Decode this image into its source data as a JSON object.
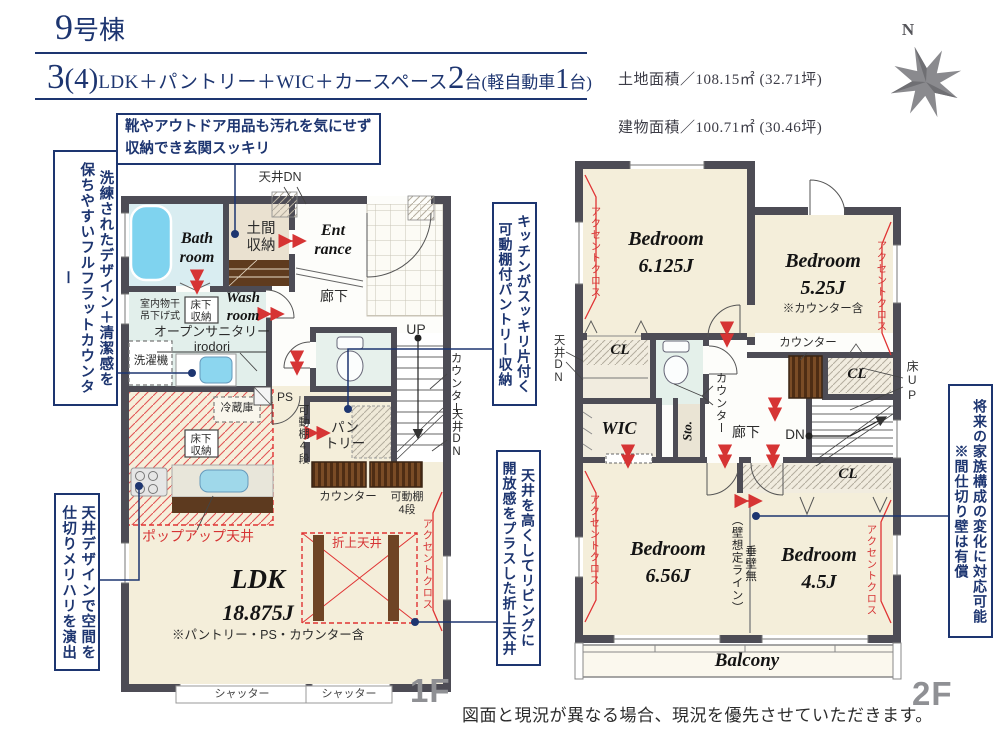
{
  "header": {
    "building_num": "9",
    "building_suffix": "号棟",
    "plan_num": "3",
    "plan_paren": "(4)",
    "plan_text": "LDK＋パントリー＋WIC＋カースペース",
    "plan_cars": "2",
    "plan_cars_unit": "台",
    "plan_kei_pre": "(軽自動車",
    "plan_kei_num": "1",
    "plan_kei_post": "台)",
    "land_area": "土地面積／108.15㎡ (32.71坪)",
    "building_area": "建物面積／100.71㎡ (30.46坪)",
    "compass_n": "N"
  },
  "callouts": {
    "genkan_l1": "靴やアウトドア用品も汚れを気にせず",
    "genkan_l2": "収納でき玄関スッキリ",
    "counter_l1": "洗練されたデザイン＋清潔感を",
    "counter_l2": "保ちやすいフルフラットカウンター",
    "pantry_l1": "キッチンがスッキリ片付く",
    "pantry_l2": "可動棚付パントリー収納",
    "ceiling_l1": "天井デザインで空間を",
    "ceiling_l2": "仕切りメリハリを演出",
    "oriage_l1": "天井を高くしてリビングに",
    "oriage_l2": "開放感をプラスした折上天井",
    "partition_l1": "将来の家族構成の変化に対応可能",
    "partition_l2": "※間仕切り壁は有償"
  },
  "floor1": {
    "floor_label": "1F",
    "tenjo_dn": "天井DN",
    "bath": "Bath\nroom",
    "doma": "土間\n収納",
    "entrance": "Ent\nrance",
    "hallway": "廊下",
    "wash": "Wash\nroom",
    "monohoshi": "室内物干\n吊下げ式",
    "yukashita": "床下\n収納",
    "sanitary": "オープンサニタリー\nirodori",
    "sentakuki": "洗濯機",
    "up": "UP",
    "ps": "PS",
    "kadodana_left": "可動棚4段",
    "pantry": "パン\nトリー",
    "reizoko": "冷蔵庫",
    "yukashita2": "床下\n収納",
    "counter": "カウンター",
    "kadodana_right": "可動棚\n4段",
    "counter_v": "カウンター",
    "tenjo_dn_v": "天井DN",
    "popup": "ポップアップ天井",
    "oriage": "折上天井",
    "accent": "アクセントクロス",
    "ldk": "LDK",
    "ldk_size": "18.875J",
    "ldk_note": "※パントリー・PS・カウンター含",
    "shutter1": "シャッター",
    "shutter2": "シャッター"
  },
  "floor2": {
    "floor_label": "2F",
    "bedroom1": "Bedroom\n6.125J",
    "bedroom2": "Bedroom\n5.25J",
    "bedroom2_note": "※カウンター含",
    "bedroom3": "Bedroom\n6.56J",
    "bedroom4": "Bedroom\n4.5J",
    "tenjo_dn": "天井DN",
    "cl1": "CL",
    "cl2": "CL",
    "cl3": "CL",
    "counter_top": "カウンター",
    "counter_v": "カウンター",
    "yuka_up": "床UP",
    "wic": "WIC",
    "sto": "Sto.",
    "hallway": "廊下",
    "dn": "DN",
    "tarekabe_l1": "垂壁無",
    "tarekabe_l2": "（壁想定ライン）",
    "accent1": "アクセントクロス",
    "accent2": "アクセントクロス",
    "accent3": "アクセントクロス",
    "accent4": "アクセントクロス",
    "balcony": "Balcony"
  },
  "footer": {
    "disclaimer": "図面と現況が異なる場合、現況を優先させていただきます。"
  }
}
